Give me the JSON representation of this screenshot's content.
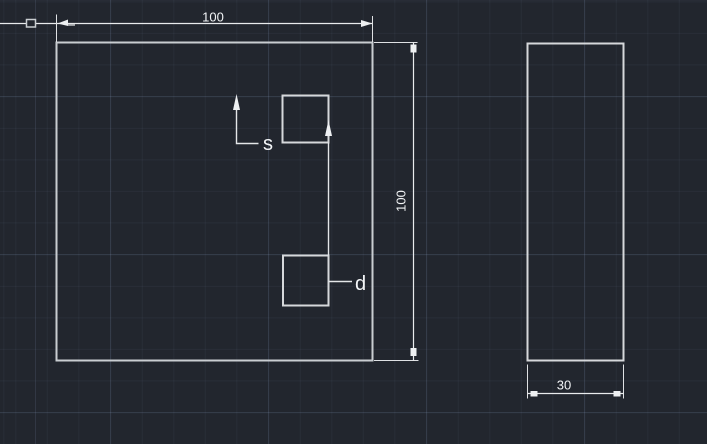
{
  "viewport": {
    "background_color": "#22262e",
    "grid_minor_color": "#2a2f38",
    "grid_major_color": "#303745",
    "geometry_line_color": "#c9cdd1",
    "dimension_line_color": "#e9ebed",
    "text_color": "#f2f4f6"
  },
  "drawing": {
    "front_view": {
      "top_dimension": "100",
      "right_dimension": "100",
      "label_s": "s",
      "label_d": "d"
    },
    "side_view": {
      "bottom_dimension": "30"
    }
  }
}
